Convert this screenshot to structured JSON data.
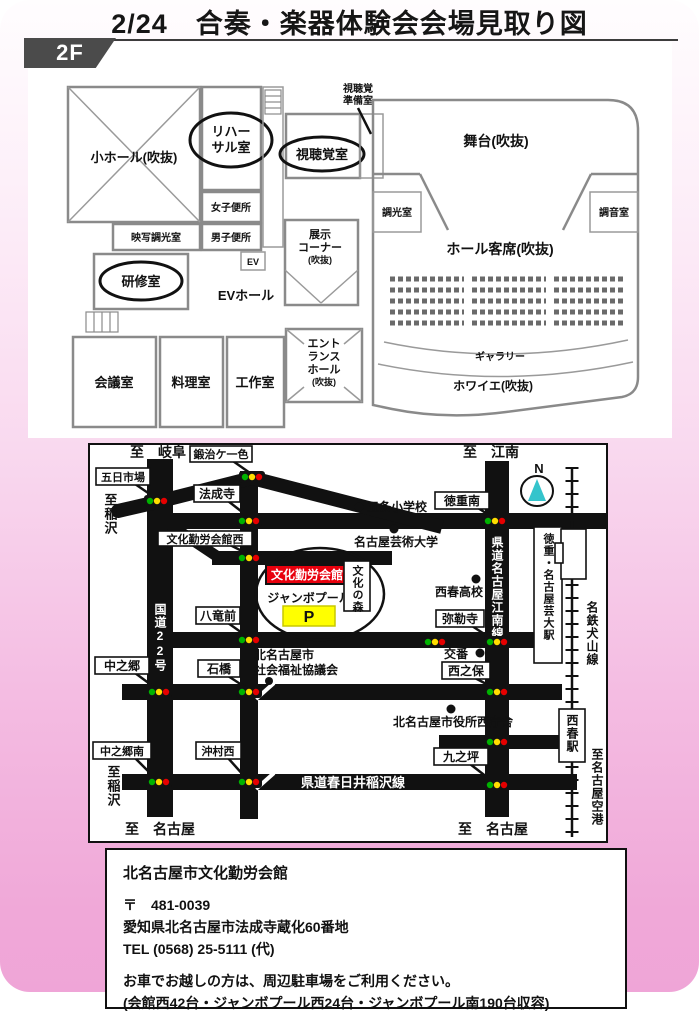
{
  "title": "2/24　合奏・楽器体験会会場見取り図",
  "floor": {
    "badge": "2F",
    "rooms": {
      "small_hall": "小ホール(吹抜)",
      "rehearsal_1": "リハー",
      "rehearsal_2": "サル室",
      "womens_toilet": "女子便所",
      "mens_toilet": "男子便所",
      "projection": "映写調光室",
      "training": "研修室",
      "ev": "EV",
      "ev_hall": "EVホール",
      "meeting": "会議室",
      "cooking": "料理室",
      "craft": "工作室",
      "entrance_1": "エント",
      "entrance_2": "ランス",
      "entrance_3": "ホール",
      "entrance_4": "(吹抜)",
      "exhibit_1": "展示",
      "exhibit_2": "コーナー",
      "exhibit_3": "(吹抜)",
      "av_room": "視聴覚室",
      "av_prep_1": "視聴覚",
      "av_prep_2": "準備室",
      "stage": "舞台(吹抜)",
      "dimming": "調光室",
      "tuning": "調音室",
      "hall_seats": "ホール客席(吹抜)",
      "gallery": "ギャラリー",
      "foyer": "ホワイエ(吹抜)"
    }
  },
  "map": {
    "to_gifu": "至　岐阜",
    "to_konan": "至　江南",
    "to_inazawa_top": "至稲沢",
    "to_inazawa_bottom": "至稲沢",
    "to_nagoya_left": "至　名古屋",
    "to_nagoya_right": "至　名古屋",
    "to_airport": "至名古屋空港",
    "compass": "N",
    "sig": {
      "kaji": "鍛治ケ一色",
      "itsuka": "五日市場",
      "hojoji": "法成寺",
      "tokushige": "徳重南",
      "kaikan_nishi": "文化勤労会館西",
      "hachiryu": "八竜前",
      "nakanogo": "中之郷",
      "ishibashi": "石橋",
      "nakanogo_s": "中之郷南",
      "okimura": "沖村西",
      "miroku": "弥勒寺",
      "nishinoho": "西之保",
      "kunotsubo": "九之坪"
    },
    "road": {
      "r22": "国道22号",
      "konan_line": "県道名古屋江南線",
      "kasugai_line": "県道春日井稲沢線",
      "meitetsu": "名鉄犬山線"
    },
    "sta": {
      "geidai": "徳重・名古屋芸大駅",
      "nishiharu": "西春駅"
    },
    "lm": {
      "gojo": "五条小学校",
      "geidai_u": "名古屋芸術大学",
      "nishiharu_hs": "西春高校",
      "koban": "交番",
      "shakyo1": "北名古屋市",
      "shakyo2": "社会福祉協議会",
      "cityhall": "北名古屋市役所西庁舎"
    },
    "venue": {
      "name": "文化勤労会館",
      "pool": "ジャンボプール",
      "parking": "P",
      "mori": "文化の森"
    }
  },
  "info": {
    "name": "北名古屋市文化勤労会館",
    "postal": "〒　481-0039",
    "address": "愛知県北名古屋市法成寺蔵化60番地",
    "tel": "TEL (0568) 25-5111 (代)",
    "note1": "お車でお越しの方は、周辺駐車場をご利用ください。",
    "note2": "(会館西42台・ジャンボプール西24台・ジャンボプール南190台収容)"
  },
  "colors": {
    "venue_red": "#e8000d",
    "parking_yellow": "#ffff00",
    "parking_green": "#00a000",
    "pink_bottom": "#efa5d7",
    "signal_green": "#00b300",
    "signal_yellow": "#ffdd00",
    "signal_red": "#e60000",
    "compass_teal": "#35c4cc"
  }
}
